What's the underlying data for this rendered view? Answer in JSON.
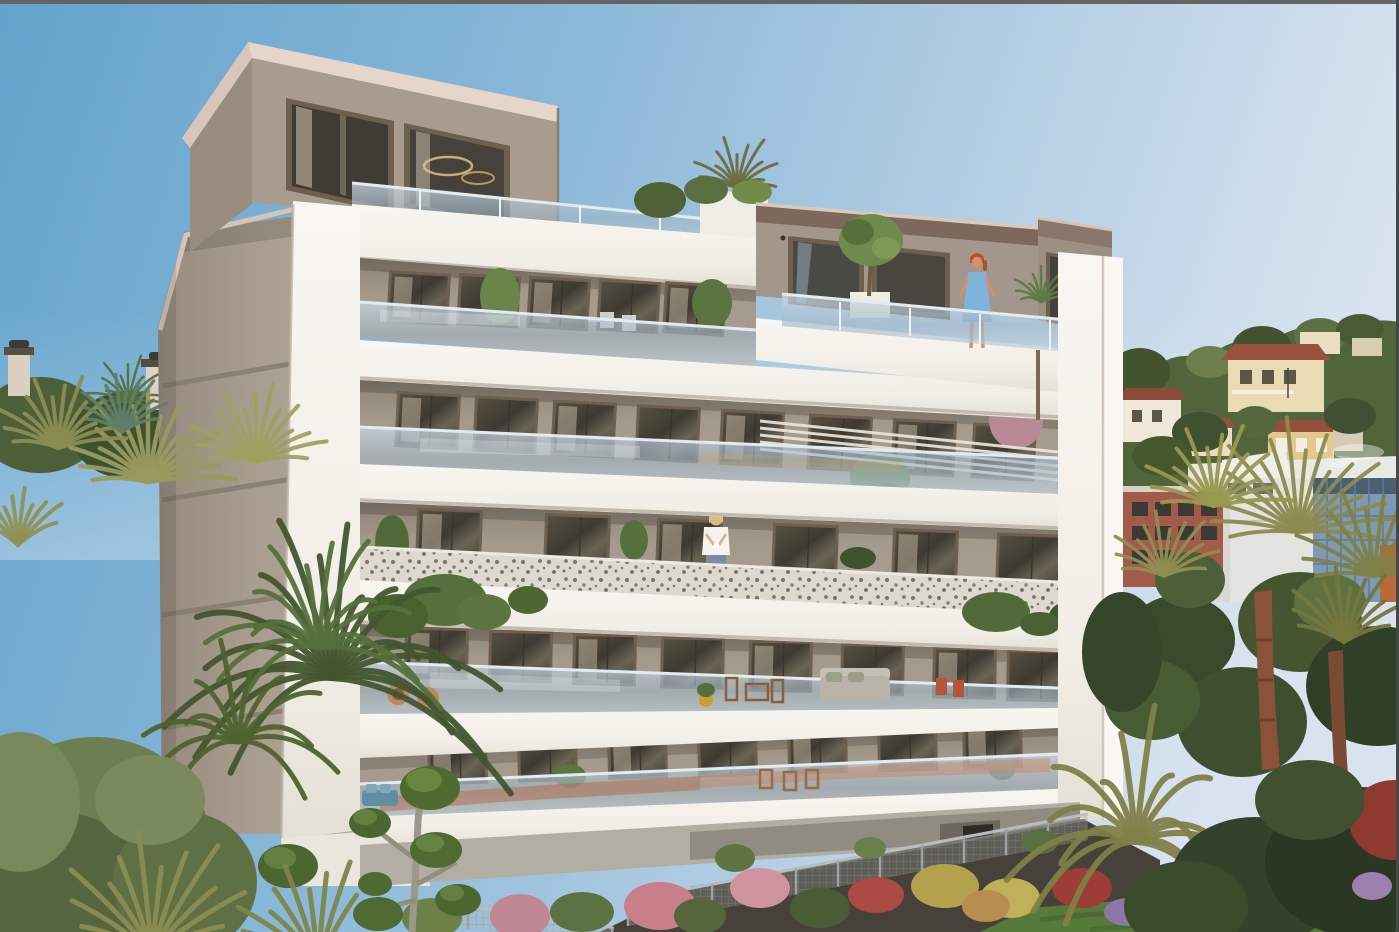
{
  "meta": {
    "type": "architectural rendering",
    "subject": "Photorealistic 3D rendering of a new modern six-storey residential apartment building with white wrap-around balcony slabs, glass balustrades and rooftop penthouses, set in Mediterranean hillside scenery with palm trees and gardens",
    "setting": "French Riviera hillside with villas, pine trees and modern buildings in the background",
    "time_of_day": "clear sunny day",
    "visible_text": ""
  },
  "palette": {
    "sky_left": "#64a3cc",
    "sky_mid": "#8ab8d8",
    "sky_pale": "#b5cfe4",
    "sky_right": "#d8e3ef",
    "border_top": "#646464",
    "border_right": "#474747",
    "white_wall": "#f2efe8",
    "white_bright": "#f8f6f1",
    "white_shade": "#e3dfd4",
    "soffit": "#b9b0a1",
    "taupe_wall": "#998e80",
    "taupe_dark": "#81766a",
    "taupe_light": "#aca192",
    "side_wall": "#a89d8e",
    "side_wall_dark": "#8f8578",
    "groove": "#847a6e",
    "fascia_pink": "#d9c6ba",
    "fascia_light": "#e6d5c9",
    "fascia_brown": "#7c695c",
    "win_frame": "#6e5f4e",
    "win_dark": "#45423a",
    "curtain": "#d3c5b0",
    "glass_tint": "#b9cad8",
    "glass_hi": "#e2ebf1",
    "perf_base": "#ded9cf",
    "perf_dot": "#6b6458",
    "terracotta1": "#b06a48",
    "terracotta2": "#c8825f",
    "cushion_blue": "#5f8fa0",
    "green_dark": "#3e5330",
    "green_mid": "#55703c",
    "green_light": "#6d8a45",
    "olive": "#8b8a4f",
    "olive_light": "#a0a060",
    "teal_green": "#5f7f66",
    "conifer": "#6d7f50",
    "conifer_dark": "#55663e",
    "trunk_red": "#8a5238",
    "trunk_dark": "#6e3f2c",
    "trunk_grey": "#9a988a",
    "topiary": "#4f6a31",
    "topiary_hi": "#6a8540",
    "hill_green": "#52643a",
    "hill_dark": "#43522f",
    "hill_light": "#6e7f4c",
    "villa_cream": "#e9dcb5",
    "villa_white": "#f0e9da",
    "villa_yellow": "#e2c98d",
    "roof_red": "#96523e",
    "roof_dark": "#5a4a3c",
    "mod_white": "#e3e4e0",
    "mod_shade": "#d8d9d3",
    "glass_blue": "#7e9ab2",
    "glass_deep": "#4a5f72",
    "accent_orange": "#b96a38",
    "red_bldg": "#a25a4a",
    "red_win": "#3d3a34",
    "base_grey": "#b3aea4",
    "base_dark": "#918c81",
    "ramp": "#46423a",
    "door_dark": "#2e2b25",
    "fence": "#9aa3a6",
    "lawn": "#567a3a",
    "lawn_dark": "#3f5c2a",
    "flower_pink": "#c87f8a",
    "flower_red": "#ab4a42",
    "flower_yellow": "#b3a14e",
    "flower_purple": "#8d76a8",
    "skin": "#d98e6a",
    "hair_red": "#b5502f",
    "dress_blue": "#7fb3d9",
    "skin2": "#e2b28c",
    "shirt_white": "#f5f3ee",
    "jeans": "#7a8ba0",
    "hair_blonde": "#d9c084",
    "chair_wood": "#9a6b40",
    "sofa_grey": "#b8b4aa",
    "pot_yellow": "#c8a030",
    "chair_red": "#b4543a",
    "wicker": "#b98a5c"
  },
  "scene": {
    "elements": [
      "clear-sky",
      "hillside-with-villas",
      "pine-forest",
      "modern-background-buildings",
      "main-apartment-building",
      "left-rooftop-penthouse",
      "right-rooftop-penthouse",
      "rooftop-terraces-with-glass-railing",
      "glass-balcony-balustrades",
      "perforated-metal-balustrade-floor",
      "pergola-slats",
      "balcony-plants",
      "outdoor-furniture",
      "garage-ramp",
      "metal-garden-fence",
      "flowering-garden",
      "lawn",
      "palm-trees-left",
      "palm-trees-right",
      "cloud-pruned-topiary-tree",
      "neighbor-chimneys",
      "woman-on-rooftop-terrace",
      "woman-on-balcony"
    ],
    "people": [
      {
        "name": "woman-on-rooftop-terrace",
        "description": "red-haired woman in a light blue dress standing at the rooftop glass railing",
        "position": "upper right penthouse terrace"
      },
      {
        "name": "woman-on-balcony",
        "description": "blonde woman in a white top holding a cup behind the perforated balustrade",
        "position": "third floor centre balcony"
      }
    ],
    "building": {
      "storeys_visible": 6,
      "penthouses": 2,
      "balustrade_types": [
        "glass",
        "perforated-metal"
      ],
      "facade_colors": [
        "white",
        "taupe"
      ],
      "has_basement_garage": true
    }
  },
  "building": {
    "x0": 360,
    "x1": 1058,
    "floors": [
      {
        "name": "floor-5",
        "wy0": 272,
        "wy1": 300,
        "wh": 46,
        "ww": 56,
        "tilt": 3.4,
        "xs": [
          392,
          462,
          532,
          602,
          668
        ]
      },
      {
        "name": "floor-4",
        "wy0": 392,
        "wy1": 430,
        "wh": 50,
        "ww": 58,
        "tilt": 3.0,
        "xs": [
          400,
          478,
          556,
          640,
          724,
          812,
          896,
          976
        ]
      },
      {
        "name": "floor-3",
        "wy0": 508,
        "wy1": 538,
        "wh": 50,
        "ww": 60,
        "tilt": 2.2,
        "xs": [
          420,
          548,
          660,
          776,
          896,
          1000
        ]
      },
      {
        "name": "floor-2",
        "wy0": 628,
        "wy1": 654,
        "wh": 46,
        "ww": 58,
        "tilt": 1.2,
        "xs": [
          408,
          492,
          576,
          664,
          752,
          844,
          936,
          1010
        ]
      },
      {
        "name": "floor-1",
        "wy0": 742,
        "wy1": 722,
        "wh": 42,
        "ww": 54,
        "tilt": -1.4,
        "xs": [
          430,
          520,
          610,
          700,
          790,
          880,
          965
        ]
      }
    ]
  },
  "vegetation": {
    "palms": [
      {
        "layer": "roof",
        "cx": 737,
        "cy": 188,
        "n": 13,
        "a0": -178,
        "a1": -2,
        "rmin": 28,
        "rmax": 55,
        "w": 3,
        "color": "#6b6b3e"
      },
      {
        "layer": "penthouse",
        "cx": 1041,
        "cy": 302,
        "n": 11,
        "a0": -172,
        "a1": -8,
        "rmin": 20,
        "rmax": 38,
        "w": 2.5,
        "color": "#5f7a44"
      },
      {
        "layer": "neighbor",
        "cx": 128,
        "cy": 402,
        "n": 15,
        "a0": -200,
        "a1": 20,
        "rmin": 22,
        "rmax": 48,
        "w": 2.5,
        "color": "#55713e"
      },
      {
        "layer": "left",
        "cx": 148,
        "cy": 482,
        "n": 17,
        "a0": -178,
        "a1": -2,
        "rmin": 55,
        "rmax": 92,
        "w": 4.5,
        "color": "#9a9a5e"
      },
      {
        "layer": "left",
        "cx": 58,
        "cy": 448,
        "n": 14,
        "a0": -172,
        "a1": -8,
        "rmin": 45,
        "rmax": 75,
        "w": 4,
        "color": "#8a8d52"
      },
      {
        "layer": "left",
        "cx": 256,
        "cy": 462,
        "n": 15,
        "a0": -176,
        "a1": -4,
        "rmin": 48,
        "rmax": 80,
        "w": 4,
        "color": "#a0a060"
      },
      {
        "layer": "left",
        "cx": 122,
        "cy": 432,
        "n": 12,
        "a0": -160,
        "a1": -20,
        "rmin": 38,
        "rmax": 60,
        "w": 3.5,
        "color": "#5f7f66"
      },
      {
        "layer": "left",
        "cx": 18,
        "cy": 545,
        "n": 10,
        "a0": -150,
        "a1": -30,
        "rmin": 38,
        "rmax": 60,
        "w": 4,
        "color": "#8f9155"
      },
      {
        "layer": "left",
        "cx": 332,
        "cy": 678,
        "n": 20,
        "a0": -195,
        "a1": 15,
        "rmin": 105,
        "rmax": 185,
        "w": 6,
        "color": "#42552f",
        "droop": 70,
        "lift": 20
      },
      {
        "layer": "left",
        "cx": 318,
        "cy": 648,
        "n": 14,
        "a0": -185,
        "a1": 5,
        "rmin": 78,
        "rmax": 135,
        "w": 5,
        "color": "#55703c",
        "droop": 50,
        "lift": 15
      },
      {
        "layer": "left",
        "cx": 238,
        "cy": 742,
        "n": 12,
        "a0": -190,
        "a1": 10,
        "rmin": 68,
        "rmax": 115,
        "w": 5,
        "color": "#4e632f",
        "droop": 45,
        "lift": 12
      },
      {
        "layer": "right",
        "cx": 1298,
        "cy": 532,
        "n": 18,
        "a0": -184,
        "a1": 4,
        "rmin": 68,
        "rmax": 115,
        "w": 4,
        "color": "#8b8a4f"
      },
      {
        "layer": "right",
        "cx": 1214,
        "cy": 506,
        "n": 14,
        "a0": -176,
        "a1": -4,
        "rmin": 52,
        "rmax": 85,
        "w": 4,
        "color": "#99984f"
      },
      {
        "layer": "right",
        "cx": 1374,
        "cy": 576,
        "n": 14,
        "a0": -180,
        "a1": 0,
        "rmin": 58,
        "rmax": 95,
        "w": 4,
        "color": "#7f8147"
      },
      {
        "layer": "right",
        "cx": 1164,
        "cy": 576,
        "n": 12,
        "a0": -170,
        "a1": -10,
        "rmin": 42,
        "rmax": 68,
        "w": 3.5,
        "color": "#8f8e52"
      },
      {
        "layer": "right",
        "cx": 1344,
        "cy": 642,
        "n": 12,
        "a0": -160,
        "a1": -20,
        "rmin": 48,
        "rmax": 78,
        "w": 4,
        "color": "#74763f"
      },
      {
        "layer": "right",
        "cx": 1136,
        "cy": 842,
        "n": 16,
        "a0": -200,
        "a1": 20,
        "rmin": 75,
        "rmax": 145,
        "w": 6,
        "color": "#7f7f48",
        "droop": 60,
        "lift": 18
      },
      {
        "layer": "bottom",
        "cx": 152,
        "cy": 952,
        "n": 12,
        "a0": -160,
        "a1": -20,
        "rmin": 75,
        "rmax": 125,
        "w": 5,
        "color": "#8a8d52"
      },
      {
        "layer": "bottom",
        "cx": 318,
        "cy": 962,
        "n": 10,
        "a0": -170,
        "a1": -60,
        "rmin": 65,
        "rmax": 105,
        "w": 5,
        "color": "#7c854c"
      }
    ],
    "bushes": [
      [
        1180,
        640,
        55,
        45,
        "#3a4a2c",
        "back"
      ],
      [
        1300,
        622,
        62,
        50,
        "#44552f",
        "back"
      ],
      [
        1378,
        686,
        72,
        60,
        "#2f4026",
        "back"
      ],
      [
        1242,
        722,
        65,
        55,
        "#3d4f2e",
        "back"
      ],
      [
        1152,
        700,
        48,
        40,
        "#475c33",
        "back"
      ],
      [
        1330,
        602,
        36,
        28,
        "#5d7240",
        "back"
      ],
      [
        1122,
        652,
        40,
        60,
        "#36462a",
        "back"
      ],
      [
        1190,
        580,
        35,
        28,
        "#4c5f38",
        "back"
      ],
      [
        500,
        296,
        20,
        28,
        "#6a854a",
        "balcony"
      ],
      [
        712,
        303,
        20,
        24,
        "#5c7440",
        "balcony"
      ],
      [
        660,
        200,
        26,
        18,
        "#4e6236",
        "balcony"
      ],
      [
        1016,
        420,
        27,
        29,
        "#b98a96",
        "balcony"
      ],
      [
        880,
        478,
        30,
        26,
        "#5d7a42",
        "balcony"
      ],
      [
        888,
        500,
        22,
        16,
        "#486034",
        "balcony"
      ],
      [
        392,
        543,
        17,
        28,
        "#4f6a38",
        "balcony"
      ],
      [
        858,
        558,
        18,
        11,
        "#3f5230",
        "balcony"
      ],
      [
        570,
        776,
        16,
        12,
        "#5a7540",
        "balcony"
      ],
      [
        1002,
        770,
        13,
        10,
        "#50683a",
        "balcony"
      ],
      [
        634,
        540,
        14,
        20,
        "#55703c",
        "balcony"
      ],
      [
        445,
        600,
        42,
        26,
        "#55703c",
        "hang"
      ],
      [
        398,
        616,
        30,
        22,
        "#49602f",
        "hang"
      ],
      [
        484,
        612,
        27,
        18,
        "#5d7340",
        "hang"
      ],
      [
        528,
        600,
        20,
        14,
        "#4e6534",
        "hang"
      ],
      [
        996,
        612,
        34,
        20,
        "#52693a",
        "hang"
      ],
      [
        1076,
        616,
        27,
        16,
        "#41552e",
        "hang"
      ],
      [
        1040,
        624,
        20,
        12,
        "#4a6034",
        "hang"
      ],
      [
        520,
        916,
        30,
        22,
        "#bf8894",
        "mid"
      ],
      [
        582,
        912,
        32,
        20,
        "#5d7242",
        "mid"
      ],
      [
        660,
        906,
        36,
        24,
        "#c87f8a",
        "mid"
      ],
      [
        700,
        916,
        26,
        18,
        "#55663c",
        "mid"
      ],
      [
        760,
        888,
        30,
        20,
        "#d093a0",
        "mid"
      ],
      [
        820,
        908,
        30,
        20,
        "#4a5c34",
        "mid"
      ],
      [
        876,
        895,
        28,
        18,
        "#ab4a42",
        "mid"
      ],
      [
        945,
        886,
        34,
        22,
        "#b3a14e",
        "mid"
      ],
      [
        1010,
        898,
        30,
        20,
        "#c0b05a",
        "mid"
      ],
      [
        986,
        906,
        24,
        16,
        "#b98d4f",
        "mid"
      ],
      [
        1082,
        888,
        30,
        20,
        "#9e3d36",
        "mid"
      ],
      [
        1128,
        912,
        24,
        14,
        "#8d76a8",
        "mid"
      ],
      [
        1160,
        898,
        16,
        10,
        "#c07a40",
        "mid"
      ],
      [
        432,
        918,
        30,
        20,
        "#6d8048",
        "mid"
      ],
      [
        735,
        858,
        20,
        14,
        "#5f7442",
        "mid"
      ],
      [
        870,
        848,
        16,
        11,
        "#6a7f4a",
        "mid"
      ],
      [
        1040,
        842,
        18,
        12,
        "#58703e",
        "mid"
      ],
      [
        1255,
        882,
        85,
        65,
        "#33422a",
        "front"
      ],
      [
        1360,
        862,
        95,
        75,
        "#2a3823",
        "front"
      ],
      [
        1186,
        906,
        62,
        45,
        "#3a4b2c",
        "front"
      ],
      [
        1394,
        820,
        45,
        40,
        "#8e3a30",
        "front"
      ],
      [
        1372,
        886,
        20,
        14,
        "#9d7fae",
        "front"
      ],
      [
        1310,
        800,
        55,
        40,
        "#3f5130",
        "front"
      ],
      [
        95,
        842,
        115,
        105,
        "#6d7f50",
        "conifer"
      ],
      [
        58,
        892,
        90,
        80,
        "#55663e",
        "conifer"
      ],
      [
        185,
        882,
        72,
        70,
        "#5e7044",
        "conifer"
      ],
      [
        20,
        802,
        60,
        70,
        "#77885a",
        "conifer"
      ],
      [
        150,
        800,
        55,
        45,
        "#7b8a5c",
        "conifer"
      ]
    ]
  },
  "garden": {
    "fences": [
      {
        "x0": 628,
        "y0": 900,
        "x1": 1088,
        "y1": 814,
        "h": 26,
        "step": 42
      },
      {
        "x0": 432,
        "y0": 902,
        "x1": 614,
        "y1": 928,
        "h": 22,
        "step": 36
      }
    ]
  }
}
